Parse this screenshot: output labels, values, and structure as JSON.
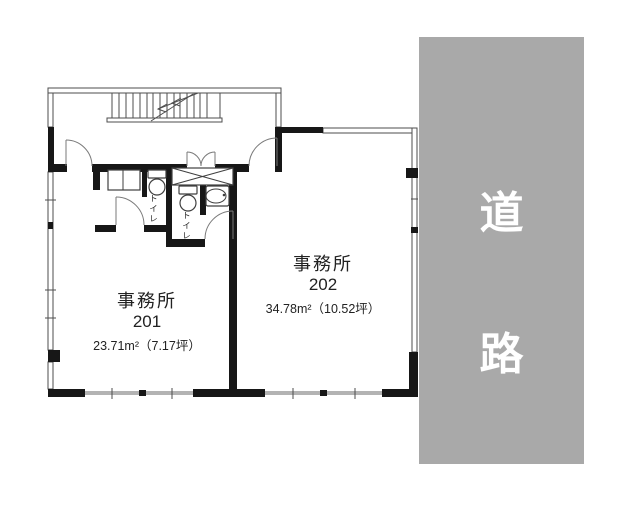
{
  "plan": {
    "title": "2F office floor plan",
    "road": {
      "chars": [
        "道",
        "路"
      ]
    },
    "office201": {
      "name": "事務所",
      "number": "201",
      "area": "23.71m²（7.17坪）"
    },
    "office202": {
      "name": "事務所",
      "number": "202",
      "area": "34.78m²（10.52坪）"
    },
    "toilet1": {
      "label": "トイレ"
    },
    "toilet2": {
      "label": "トイレ"
    }
  },
  "colors": {
    "road_fill": "#a9a9a9",
    "road_text": "#ffffff",
    "wall": "#171717",
    "window_band": "#b3b3b3",
    "thin_line": "#4d4d4d",
    "label_text": "#222222"
  }
}
